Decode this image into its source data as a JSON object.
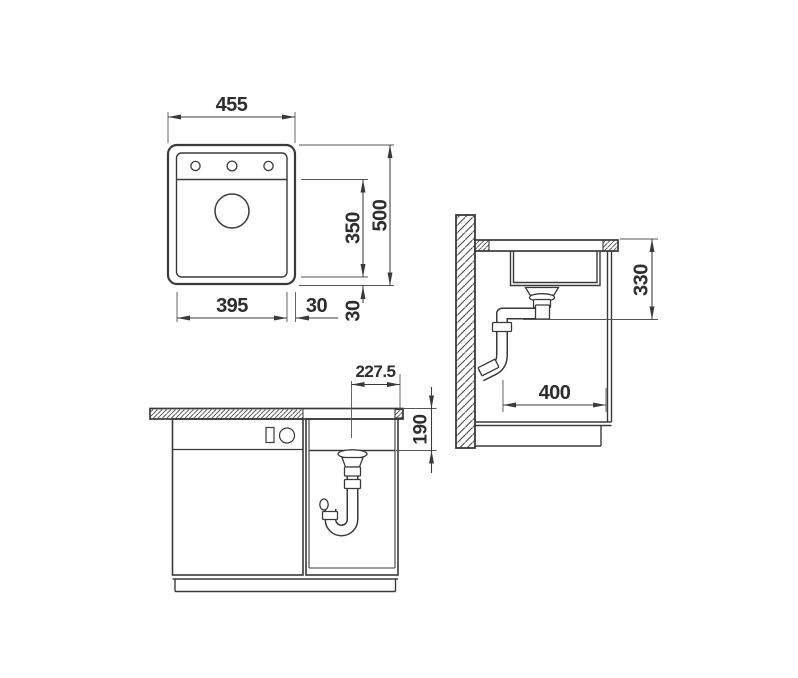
{
  "meta": {
    "background": "#ffffff",
    "line_color": "#3a3a3a",
    "drawing_kind": "sink installation dimension drawing"
  },
  "views": {
    "top": {
      "name": "top-view",
      "dims": {
        "overall_width": "455",
        "overall_depth": "500",
        "bowl_depth": "350",
        "bowl_width": "395",
        "offset_right": "30",
        "offset_front": "30"
      }
    },
    "side": {
      "name": "side-section-view",
      "dims": {
        "drain_clearance_height": "330",
        "base_cabinet_depth": "400"
      }
    },
    "front": {
      "name": "front-view",
      "dims": {
        "drain_center_from_edge": "227.5",
        "bowl_height": "190"
      }
    }
  }
}
